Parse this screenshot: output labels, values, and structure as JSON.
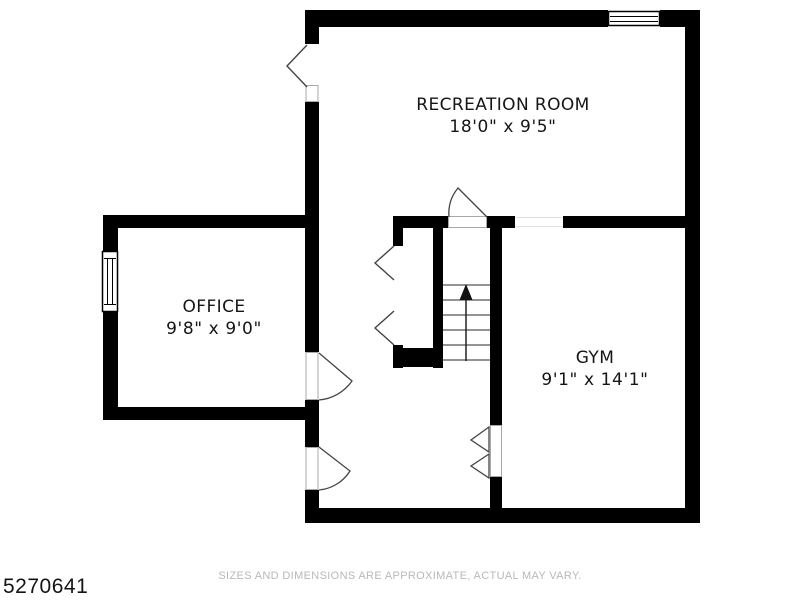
{
  "page": {
    "background": "#ffffff"
  },
  "colors": {
    "wall": "#000000",
    "label_text": "#151515",
    "disclaimer_text": "#b8b8b8"
  },
  "rooms": [
    {
      "name": "RECREATION ROOM",
      "dimensions": "18'0\" x 9'5\""
    },
    {
      "name": "OFFICE",
      "dimensions": "9'8\" x 9'0\""
    },
    {
      "name": "GYM",
      "dimensions": "9'1\" x 14'1\""
    }
  ],
  "footer": {
    "listing_id": "5270641",
    "disclaimer": "SIZES AND DIMENSIONS ARE APPROXIMATE, ACTUAL MAY VARY."
  }
}
